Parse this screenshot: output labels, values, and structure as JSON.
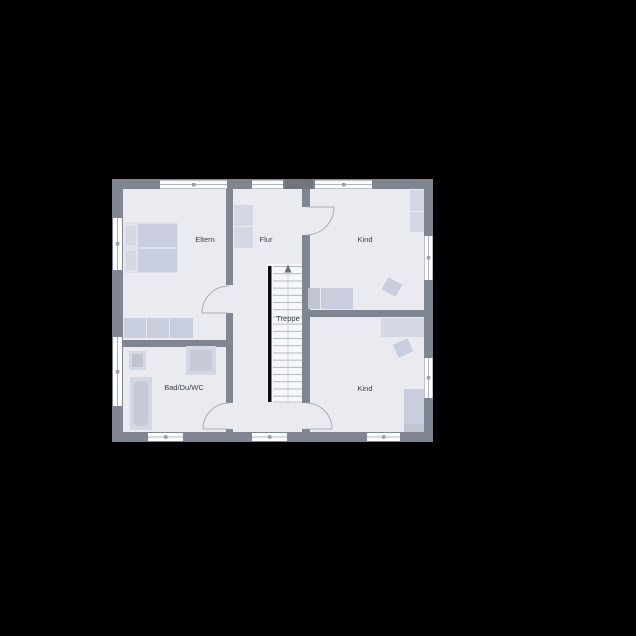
{
  "colors": {
    "background": "#000000",
    "wall": "#7f8591",
    "wall_dark": "#6f747e",
    "floor": "#e9ebf1",
    "stair_floor": "#f6f7fa",
    "window": "#fdfdfe",
    "furniture_light": "#d4d8e2",
    "furniture_mid": "#c9cede",
    "furniture_dark": "#c0c5d0",
    "door_arc": "#a7adb9",
    "stair_stringer": "#0d0d10",
    "label_text": "#3c414c"
  },
  "floorplan": {
    "rooms": [
      {
        "id": "eltern",
        "label": "Eltern"
      },
      {
        "id": "flur",
        "label": "Flur"
      },
      {
        "id": "kind_top",
        "label": "Kind"
      },
      {
        "id": "treppe",
        "label": "Treppe"
      },
      {
        "id": "bad",
        "label": "Bad/Du/WC"
      },
      {
        "id": "kind_bottom",
        "label": "Kind"
      }
    ]
  }
}
